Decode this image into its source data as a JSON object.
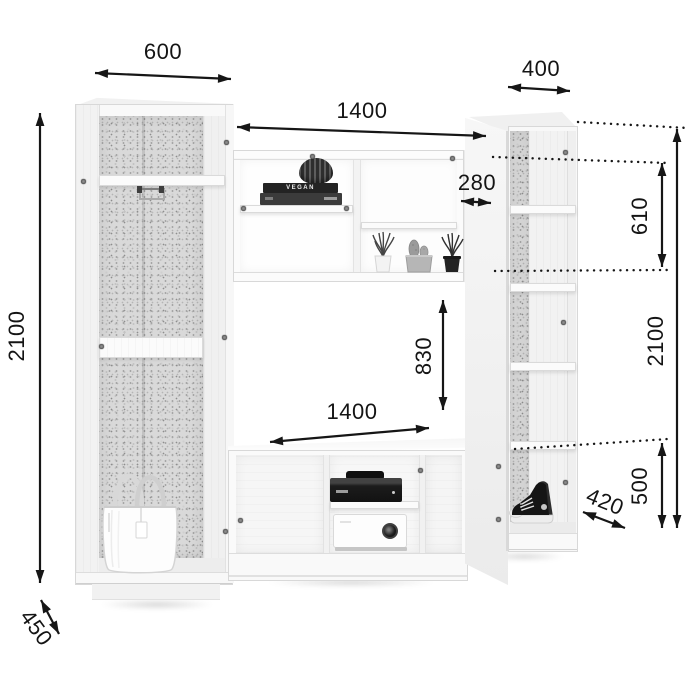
{
  "diagram": {
    "background": "#ffffff",
    "line_color": "#161616",
    "furniture_color": "#f8f8f8",
    "back_panel_color": "#d9d9d9",
    "dims": {
      "left_section_width": "600",
      "right_section_width": "400",
      "center_section_width": "1400",
      "upper_shelf_depth": "280",
      "upper_section_height": "610",
      "total_height_left": "2100",
      "total_height_right": "2100",
      "niche_height": "830",
      "niche_width": "1400",
      "base_section_height": "500",
      "right_section_depth": "420",
      "left_section_depth": "450"
    },
    "decor": {
      "book_spine_text": "VEGAN"
    }
  }
}
